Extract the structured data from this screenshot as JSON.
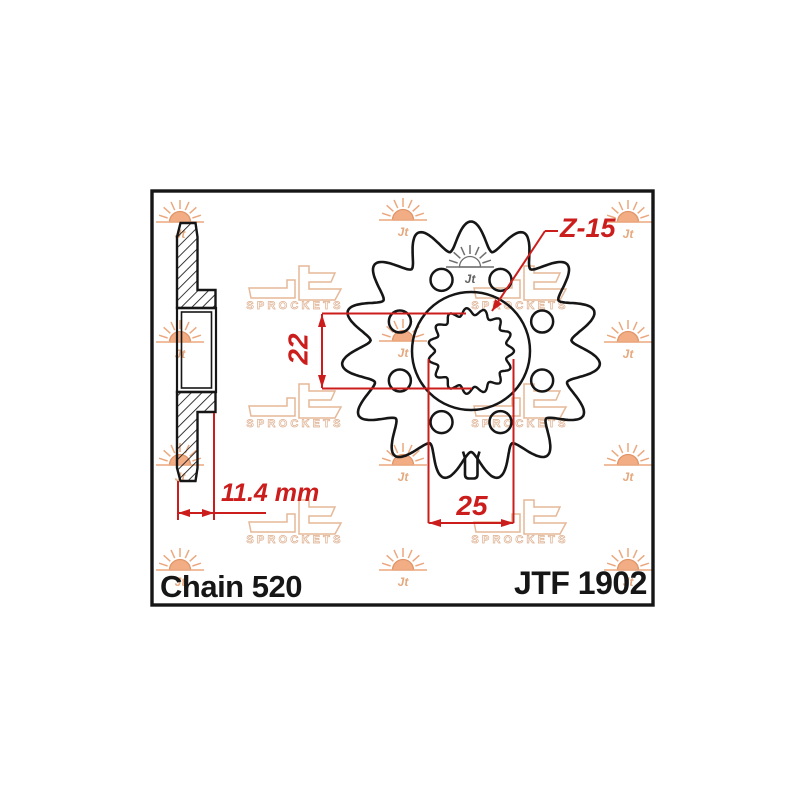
{
  "drawing": {
    "part_number": "JTF 1902",
    "chain_spec": "Chain 520",
    "teeth_label": "Z-15",
    "dimensions": {
      "bore_diameter": "22",
      "spline_outer_diameter": "25",
      "sprocket_width": "11.4 mm"
    },
    "sprocket": {
      "teeth_count": 15,
      "lightening_holes": 8
    },
    "watermark": {
      "logo_text": "Jt",
      "logo_subtext": "SPROCKETS"
    },
    "colors": {
      "dimension_red": "#cc1d1d",
      "outline_black": "#161616",
      "watermark_peach": "#e7b795",
      "background": "#ffffff"
    }
  }
}
